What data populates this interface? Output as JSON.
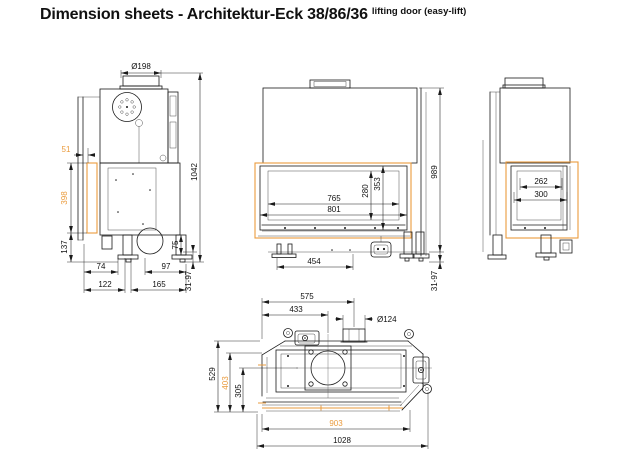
{
  "title": {
    "main": "Dimension sheets - Architektur-Eck 38/86/36",
    "suffix": "lifting door (easy-lift)"
  },
  "colors": {
    "line": "#1a1a1a",
    "highlight": "#ea9b3d",
    "background": "#ffffff"
  },
  "views": {
    "side": {
      "dims": {
        "flue": "Ø198",
        "d51": "51",
        "d398": "398",
        "d1042": "1042",
        "d137": "137",
        "d74": "74",
        "d97": "97",
        "d122": "122",
        "d165": "165",
        "d75": "75",
        "leg_range": "31-97"
      }
    },
    "front": {
      "dims": {
        "d765": "765",
        "d801": "801",
        "d280": "280",
        "d353": "353",
        "d454": "454",
        "d989": "989",
        "leg_range": "31-97"
      }
    },
    "right": {
      "dims": {
        "d262": "262",
        "d300": "300"
      }
    },
    "plan": {
      "dims": {
        "d575": "575",
        "d433": "433",
        "flue": "Ø124",
        "d529": "529",
        "d403": "403",
        "d305": "305",
        "d903": "903",
        "d1028": "1028"
      }
    }
  }
}
